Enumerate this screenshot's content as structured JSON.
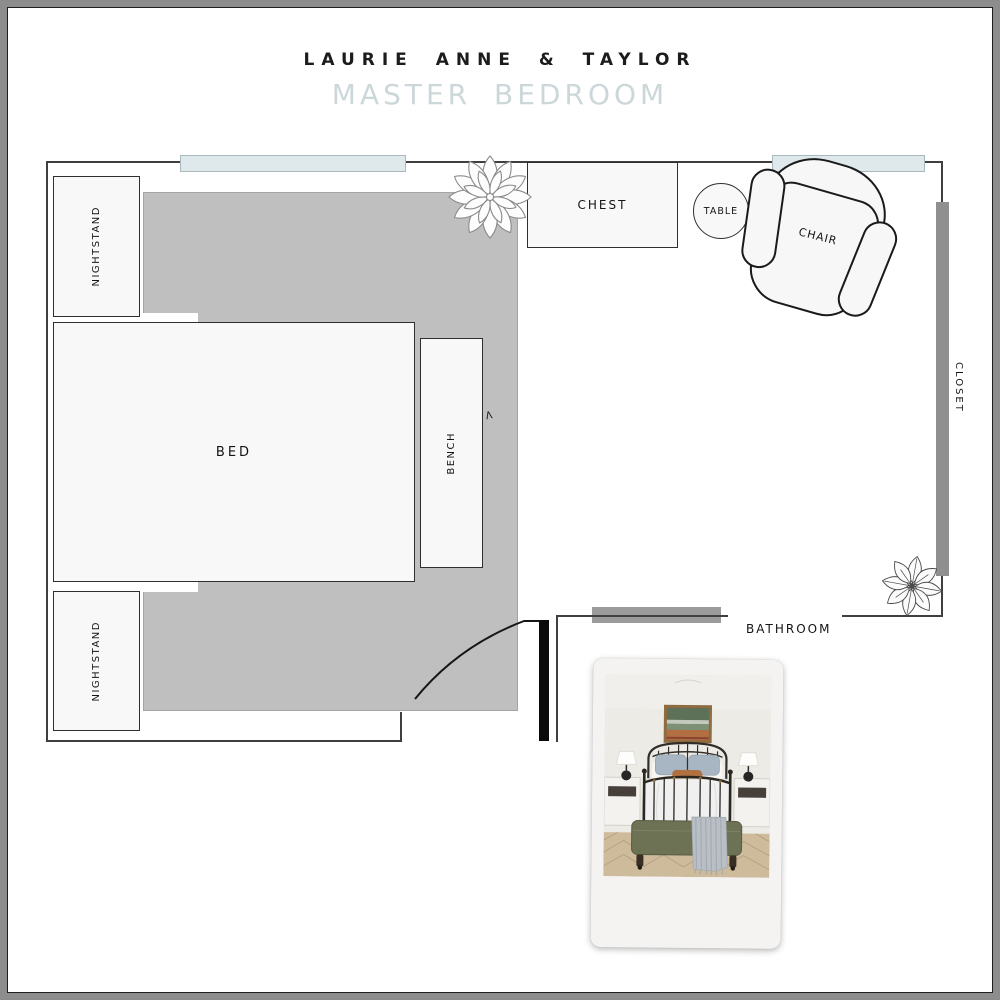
{
  "header": {
    "client_name": "LAURIE ANNE & TAYLOR",
    "room_title": "MASTER BEDROOM"
  },
  "plan": {
    "rooms": {
      "bathroom_label": "BATHROOM",
      "closet_label": "CLOSET"
    },
    "furniture": {
      "nightstand_top_label": "NIGHTSTAND",
      "nightstand_bottom_label": "NIGHTSTAND",
      "bed_label": "BED",
      "bench_label": "BENCH",
      "chest_label": "CHEST",
      "table_label": "TABLE",
      "chair_label": "CHAIR"
    },
    "marks": {
      "door_check": "<"
    },
    "colors": {
      "rug": "#bfbfbf",
      "window_fill": "#dfe8ea",
      "window_border": "#a9babe",
      "closet_bar": "#8f8f8f",
      "bathroom_opening_bar": "#9b9b9b",
      "wall_line": "#3f3f3f",
      "door": "#0a0a0a",
      "room_title_accent": "#ccd7d9",
      "outer_frame": "#8d8d8d",
      "furniture_fill": "#f8f8f8"
    }
  }
}
